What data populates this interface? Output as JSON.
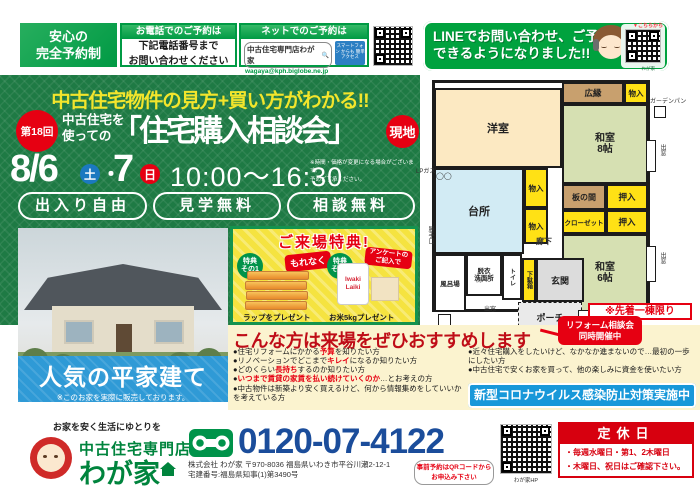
{
  "topbar": {
    "badge_line1": "安心の",
    "badge_line2": "完全予約制",
    "phone_box": {
      "header": "お電話でのご予約は",
      "line1": "下記電話番号まで",
      "line2": "お問い合わせください"
    },
    "net_box": {
      "header": "ネットでのご予約は",
      "search_text": "中古住宅専門店わが家",
      "search_icon": "🔍",
      "email": "wagaya@kph.biglobe.ne.jp",
      "tag": "スマートフォン からも 簡単アクセス"
    },
    "line_box": {
      "line1": "LINEでお問い合わせ、ご予約",
      "line2": "できるようになりました!!",
      "qr_label": "▼こちらから",
      "qr_caption": "わが家"
    }
  },
  "main": {
    "catch": "中古住宅物件の見方+買い方がわかる!!",
    "round_badge": "第18回",
    "lead_line1": "中古住宅を",
    "lead_line2": "使っての",
    "title": "「住宅購入相談会」",
    "site_badge": "現地",
    "date_main": "8/6",
    "date_sat": "土",
    "date_sep": "・",
    "date_day2": "7",
    "date_sun": "日",
    "time": "10:00〜16:30",
    "note_line1": "※時間・価格が変更になる場合がございます。",
    "note_line2": "予めご了承ください。",
    "pill1": "出入り自由",
    "pill2": "見学無料",
    "pill3": "相談無料"
  },
  "photo_band": {
    "title": "人気の平家建て",
    "note": "※このお家を実際に販売しております。"
  },
  "benefits": {
    "title": "ご来場特典!",
    "item1": {
      "badge_line1": "特典",
      "badge_line2": "その1",
      "burst": "もれなく",
      "caption": "ラップをプレゼント"
    },
    "item2": {
      "badge_line1": "特典",
      "badge_line2": "その2",
      "burst_line1": "アンケートの",
      "burst_line2": "ご記入で",
      "product": "Iwaki Laiki",
      "caption": "お米5kgプレゼント"
    }
  },
  "floorplan": {
    "western": "洋室",
    "hiroen": "広縁",
    "monoire": "物入",
    "washitsu8_1": "和室",
    "washitsu8_2": "8帖",
    "washitsu6_1": "和室",
    "washitsu6_2": "6帖",
    "kitchen": "台所",
    "itanoma": "板の間",
    "oshiire": "押入",
    "closet": "クローゼット",
    "rouka": "廊下",
    "datsui_1": "脱衣",
    "datsui_2": "洗面所",
    "furoba": "風呂場",
    "toilet": "トイレ",
    "getabako": "下駄箱",
    "genkan": "玄関",
    "porch": "ポーチ",
    "garden_pan": "ガーデンパン",
    "lp_gas": "LPガス",
    "katteguchi": "勝手口",
    "kyutoki": "給湯器",
    "demado": "出窓",
    "sen_pan": "洗パン",
    "limited": "※先着一棟限り"
  },
  "recommend": {
    "title": "こんな方は来場をぜひおすすめします",
    "ribbon_line1": "リフォーム相談会",
    "ribbon_line2": "同時開催中",
    "left": [
      {
        "pre": "●住宅リフォームにかかる",
        "em": "予算",
        "post": "を知りたい方"
      },
      {
        "pre": "●リノベーションでどこまで",
        "em": "キレイ",
        "post": "になるか知りたい方"
      },
      {
        "pre": "●どのくらい",
        "em": "長持ち",
        "post": "するのか知りたい方"
      },
      {
        "pre": "●",
        "em": "いつまで賃貸の家賃を払い続けていくのか",
        "post": "…とお考えの方"
      },
      {
        "pre": "●中古物件は新築より安く買えるけど、何から情報集めをしていいかを考えている方",
        "em": "",
        "post": ""
      }
    ],
    "right": [
      {
        "pre": "●近々住宅購入をしたいけど、なかなか進まないので…最初の一歩にしたい方",
        "em": "",
        "post": ""
      },
      {
        "pre": "●中古住宅で安くお家を買って、他の楽しみに資金を使いたい方",
        "em": "",
        "post": ""
      }
    ],
    "covid": "新型コロナウイルス感染防止対策実施中"
  },
  "footer": {
    "slogan": "お家を安く生活にゆとりを",
    "store_type": "中古住宅専門店",
    "store_name": "わが家",
    "phone": "0120-07-4122",
    "company_line1": "株式会社 わが家 〒970-8036 福島県いわき市平谷川瀬2-12-1",
    "company_line2": "宅建番号:福島県知事(1)第3490号",
    "bubble_line1": "事前予約はQRコードから",
    "bubble_line2": "お申込み下さい",
    "qr_caption": "わが家HP",
    "holiday_title": "定休日",
    "holiday_line1": "・毎週水曜日・第1、2木曜日",
    "holiday_line2": "・木曜日、祝日はご確認下さい。"
  }
}
